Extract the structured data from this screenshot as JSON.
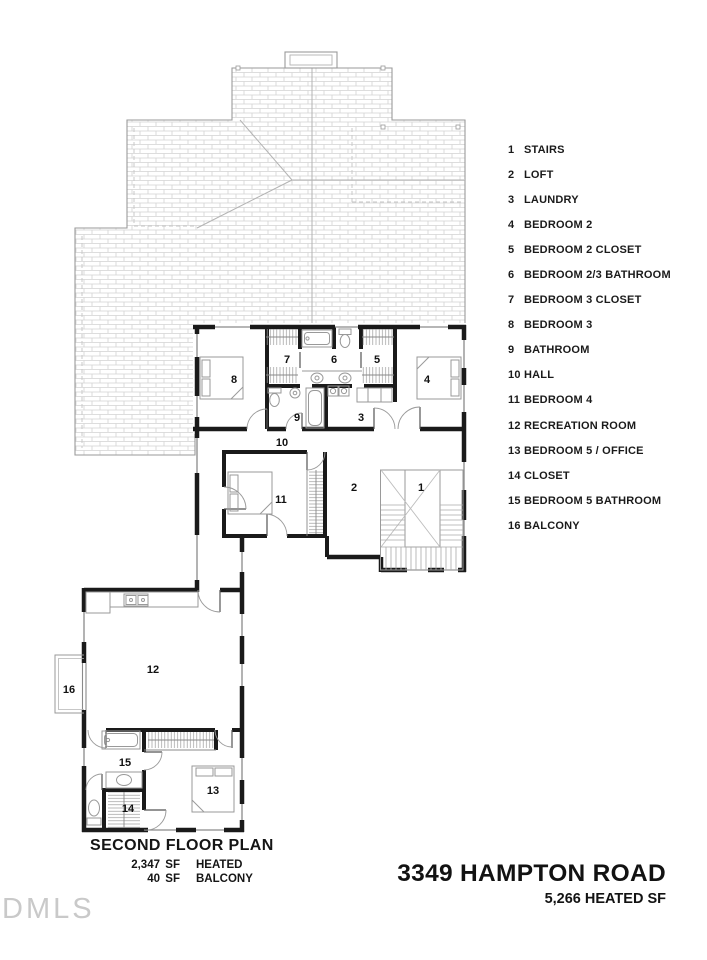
{
  "legend": {
    "items": [
      {
        "num": "1",
        "label": "STAIRS"
      },
      {
        "num": "2",
        "label": "LOFT"
      },
      {
        "num": "3",
        "label": "LAUNDRY"
      },
      {
        "num": "4",
        "label": "BEDROOM 2"
      },
      {
        "num": "5",
        "label": "BEDROOM 2 CLOSET"
      },
      {
        "num": "6",
        "label": "BEDROOM 2/3 BATHROOM"
      },
      {
        "num": "7",
        "label": "BEDROOM 3 CLOSET"
      },
      {
        "num": "8",
        "label": "BEDROOM 3"
      },
      {
        "num": "9",
        "label": "BATHROOM"
      },
      {
        "num": "10",
        "label": "HALL"
      },
      {
        "num": "11",
        "label": "BEDROOM 4"
      },
      {
        "num": "12",
        "label": "RECREATION ROOM"
      },
      {
        "num": "13",
        "label": "BEDROOM 5 / OFFICE"
      },
      {
        "num": "14",
        "label": "CLOSET"
      },
      {
        "num": "15",
        "label": "BEDROOM 5 BATHROOM"
      },
      {
        "num": "16",
        "label": "BALCONY"
      }
    ]
  },
  "plan": {
    "room_numbers": [
      "1",
      "2",
      "3",
      "4",
      "5",
      "6",
      "7",
      "8",
      "9",
      "10",
      "11",
      "12",
      "13",
      "14",
      "15",
      "16"
    ]
  },
  "title_block": {
    "title": "SECOND FLOOR PLAN",
    "areas": [
      {
        "value": "2,347",
        "unit": "SF",
        "label": "HEATED"
      },
      {
        "value": "40",
        "unit": "SF",
        "label": "BALCONY"
      }
    ]
  },
  "address_block": {
    "address": "3349 HAMPTON ROAD",
    "total": "5,266 HEATED SF"
  },
  "watermark": "DMLS",
  "colors": {
    "wall": "#1a1a1a",
    "fixture_line": "#999999",
    "roof_hatch": "#d2d2d2",
    "text": "#111111",
    "watermark": "#c9c9c9"
  }
}
